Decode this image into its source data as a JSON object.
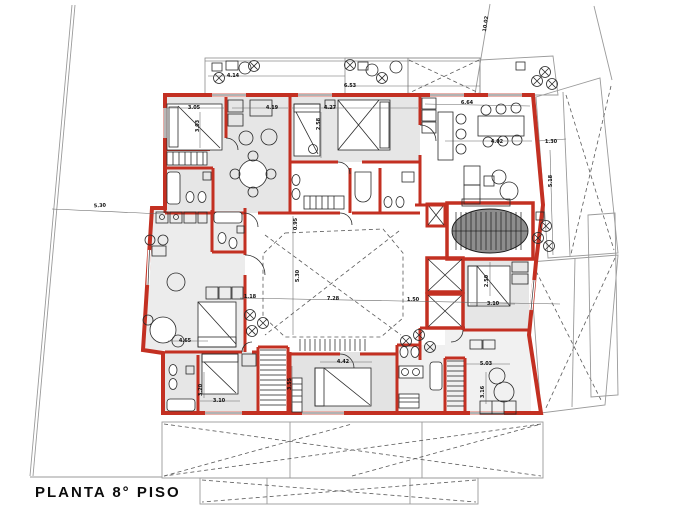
{
  "title": {
    "text": "PLANTA 8° PISO"
  },
  "colors": {
    "wall_red": "#c33022",
    "room_gray": "#e6e6e6",
    "core_gray": "#8d8d8d",
    "paper_white": "#ffffff"
  },
  "annotations": {
    "dimensions": [
      {
        "text": "4.14",
        "x": 233,
        "y": 77,
        "rot": 0
      },
      {
        "text": "6.53",
        "x": 350,
        "y": 87,
        "rot": 0
      },
      {
        "text": "10.02",
        "x": 487,
        "y": 24,
        "rot": -82
      },
      {
        "text": "3.05",
        "x": 194,
        "y": 109,
        "rot": 0
      },
      {
        "text": "3.03",
        "x": 199,
        "y": 126,
        "rot": -90
      },
      {
        "text": "4.19",
        "x": 272,
        "y": 109,
        "rot": 0
      },
      {
        "text": "4.27",
        "x": 330,
        "y": 109,
        "rot": 0
      },
      {
        "text": "2.58",
        "x": 320,
        "y": 124,
        "rot": -90
      },
      {
        "text": "6.64",
        "x": 467,
        "y": 104,
        "rot": 0
      },
      {
        "text": "4.02",
        "x": 497,
        "y": 143,
        "rot": 0
      },
      {
        "text": "1.30",
        "x": 551,
        "y": 143,
        "rot": 0
      },
      {
        "text": "5.18",
        "x": 552,
        "y": 181,
        "rot": -90
      },
      {
        "text": "5.30",
        "x": 100,
        "y": 207,
        "rot": -4
      },
      {
        "text": "0.95",
        "x": 297,
        "y": 224,
        "rot": -90
      },
      {
        "text": "1.18",
        "x": 250,
        "y": 298,
        "rot": 0
      },
      {
        "text": "7.28",
        "x": 333,
        "y": 300,
        "rot": 0
      },
      {
        "text": "1.50",
        "x": 413,
        "y": 301,
        "rot": 0
      },
      {
        "text": "5.30",
        "x": 299,
        "y": 276,
        "rot": -90
      },
      {
        "text": "4.65",
        "x": 185,
        "y": 342,
        "rot": 0
      },
      {
        "text": "3.10",
        "x": 219,
        "y": 402,
        "rot": 0
      },
      {
        "text": "3.20",
        "x": 202,
        "y": 390,
        "rot": -90
      },
      {
        "text": "4.42",
        "x": 343,
        "y": 363,
        "rot": 0
      },
      {
        "text": "3.55",
        "x": 291,
        "y": 384,
        "rot": -90
      },
      {
        "text": "5.03",
        "x": 486,
        "y": 365,
        "rot": 0
      },
      {
        "text": "3.16",
        "x": 484,
        "y": 392,
        "rot": -90
      },
      {
        "text": "2.50",
        "x": 488,
        "y": 281,
        "rot": -90
      },
      {
        "text": "3.10",
        "x": 493,
        "y": 305,
        "rot": 0
      }
    ]
  }
}
